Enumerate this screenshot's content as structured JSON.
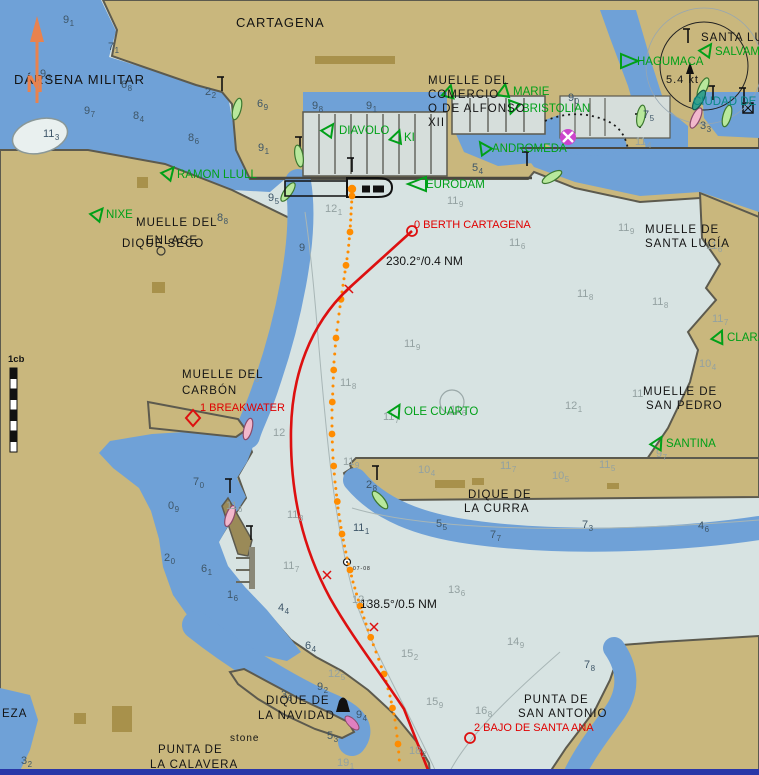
{
  "chart": {
    "north_label": "N",
    "scale_label": "1cb",
    "colors": {
      "water_deep": "#D7E3E2",
      "water_blue": "#6FA1D7",
      "lake": "#E9F0EF",
      "land": "#C9B77D",
      "land_dark": "#A8914B",
      "marina": "#D6DEDB",
      "edge": "#5C5A4E",
      "route_red": "#DD1010",
      "track_orange": "#FF8C00",
      "vessel_green": "#00A018",
      "vessel_teal": "#0A8A86",
      "sound_dark": "#3E5668",
      "sound_light": "#93A1A1",
      "north_orange": "#E8824E",
      "bottom_bar": "#2937A8"
    },
    "place_labels": [
      {
        "t": "CARTAGENA",
        "x": 236,
        "y": 27,
        "s": 13,
        "c": "#141414"
      },
      {
        "t": "DÁRSENA MILITAR",
        "x": 14,
        "y": 84,
        "s": 13,
        "c": "#141414"
      },
      {
        "t": "MUELLE DEL",
        "x": 428,
        "y": 84,
        "s": 11.5,
        "c": "#141414"
      },
      {
        "t": "COMERCIO",
        "x": 428,
        "y": 98,
        "s": 11.5,
        "c": "#141414"
      },
      {
        "t": "O DE ALFONSO",
        "x": 428,
        "y": 112,
        "s": 11.5,
        "c": "#141414"
      },
      {
        "t": "XII",
        "x": 428,
        "y": 126,
        "s": 11.5,
        "c": "#141414"
      },
      {
        "t": "SANTA LU",
        "x": 701,
        "y": 41,
        "s": 11.5,
        "c": "#141414"
      },
      {
        "t": "MUELLE DEL",
        "x": 136,
        "y": 226,
        "s": 11.5,
        "c": "#141414"
      },
      {
        "t": "ENLACE",
        "x": 146,
        "y": 244,
        "s": 11.5,
        "c": "#141414"
      },
      {
        "t": "DIQUE SECO",
        "x": 122,
        "y": 247,
        "s": 11.5,
        "c": "#141414"
      },
      {
        "t": "MUELLE DE",
        "x": 645,
        "y": 233,
        "s": 11.5,
        "c": "#141414"
      },
      {
        "t": "SANTA LUCÍA",
        "x": 645,
        "y": 247,
        "s": 11.5,
        "c": "#141414"
      },
      {
        "t": "MUELLE DEL",
        "x": 182,
        "y": 378,
        "s": 11.5,
        "c": "#141414"
      },
      {
        "t": "CARBÓN",
        "x": 182,
        "y": 394,
        "s": 11.5,
        "c": "#141414"
      },
      {
        "t": "MUELLE DE",
        "x": 643,
        "y": 395,
        "s": 11.5,
        "c": "#141414"
      },
      {
        "t": "SAN PEDRO",
        "x": 646,
        "y": 409,
        "s": 11.5,
        "c": "#141414"
      },
      {
        "t": "DIQUE DE",
        "x": 468,
        "y": 498,
        "s": 11.5,
        "c": "#141414"
      },
      {
        "t": "LA CURRA",
        "x": 464,
        "y": 512,
        "s": 11.5,
        "c": "#141414"
      },
      {
        "t": "DIQUE DE",
        "x": 266,
        "y": 704,
        "s": 11.5,
        "c": "#141414"
      },
      {
        "t": "LA NAVIDAD",
        "x": 258,
        "y": 719,
        "s": 11.5,
        "c": "#141414"
      },
      {
        "t": "PUNTA DE",
        "x": 158,
        "y": 753,
        "s": 11.5,
        "c": "#141414"
      },
      {
        "t": "LA CALAVERA",
        "x": 150,
        "y": 768,
        "s": 11.5,
        "c": "#141414"
      },
      {
        "t": "PUNTA DE",
        "x": 524,
        "y": 703,
        "s": 11.5,
        "c": "#141414"
      },
      {
        "t": "SAN ANTONIO",
        "x": 518,
        "y": 717,
        "s": 11.5,
        "c": "#141414"
      },
      {
        "t": "stone",
        "x": 230,
        "y": 741,
        "s": 10,
        "c": "#141414"
      },
      {
        "t": "EZA",
        "x": 2,
        "y": 717,
        "s": 11.5,
        "c": "#141414"
      },
      {
        "t": "5.4 kt",
        "x": 666,
        "y": 83,
        "s": 11,
        "c": "#141414"
      },
      {
        "t": "07-08",
        "x": 353,
        "y": 570,
        "s": 5,
        "c": "#141414"
      }
    ],
    "vessel_labels": [
      {
        "name": "HAGUMACA",
        "x": 637,
        "y": 65,
        "c": "#00A018",
        "tri": [
          629,
          61,
          90
        ],
        "shape": "right"
      },
      {
        "name": "SALVAMA",
        "x": 715,
        "y": 55,
        "c": "#00A018",
        "tri": [
          707,
          50,
          35
        ]
      },
      {
        "name": "MARIE",
        "x": 513,
        "y": 95,
        "c": "#00A018",
        "tri": [
          504,
          91,
          10
        ]
      },
      {
        "name": "BRISTOLIAN",
        "x": 522,
        "y": 112,
        "c": "#00A018",
        "tri": [
          513,
          107,
          200
        ]
      },
      {
        "name": "DIAVOLO",
        "x": 339,
        "y": 134,
        "c": "#00A018",
        "tri": [
          329,
          130,
          35
        ]
      },
      {
        "name": "KI",
        "x": 404,
        "y": 141,
        "c": "#00A018",
        "tri": [
          397,
          137,
          20
        ]
      },
      {
        "name": "ANDROMEDA",
        "x": 492,
        "y": 152,
        "c": "#00A018",
        "tri": [
          484,
          148,
          325
        ]
      },
      {
        "name": "EURODAM",
        "x": 426,
        "y": 188,
        "c": "#00A018",
        "tri": [
          417,
          184,
          0
        ],
        "shape": "left"
      },
      {
        "name": "RAMON LLULL",
        "x": 177,
        "y": 178,
        "c": "#00A018",
        "tri": [
          169,
          173,
          40
        ]
      },
      {
        "name": "NIXE",
        "x": 106,
        "y": 218,
        "c": "#00A018",
        "tri": [
          98,
          214,
          40
        ]
      },
      {
        "name": "OLE CUARTO",
        "x": 404,
        "y": 415,
        "c": "#00A018",
        "tri": [
          396,
          411,
          30
        ]
      },
      {
        "name": "CLARA",
        "x": 727,
        "y": 341,
        "c": "#00A018",
        "tri": [
          719,
          337,
          25
        ]
      },
      {
        "name": "SANTINA",
        "x": 666,
        "y": 447,
        "c": "#00A018",
        "tri": [
          658,
          443,
          30
        ]
      },
      {
        "name": "CIUDAD DE",
        "x": 693,
        "y": 105,
        "c": "#0A8A86",
        "tri": null
      },
      {
        "name": "",
        "x": 0,
        "y": 0,
        "c": "#00A018",
        "tri": [
          449,
          92,
          15
        ]
      }
    ],
    "route": {
      "path": "M412,231 L348,289 C310,325 292,375 291,430 C290,495 303,548 330,598 C352,637 381,674 404,709 L430,775",
      "tick_marks": [
        [
          349,
          289
        ],
        [
          327,
          575
        ],
        [
          374,
          627
        ]
      ],
      "waypoints": [
        {
          "name": "0 BERTH CARTAGENA",
          "x": 412,
          "y": 231,
          "symbol": "circle",
          "lx": 414,
          "ly": 228
        },
        {
          "name": "1 BREAKWATER",
          "x": 193,
          "y": 418,
          "symbol": "diamond",
          "lx": 200,
          "ly": 411
        },
        {
          "name": "2 BAJO DE SANTA ANA",
          "x": 470,
          "y": 738,
          "symbol": "circle",
          "lx": 474,
          "ly": 731
        }
      ],
      "legs": [
        {
          "label": "230.2°/0.4 NM",
          "x": 386,
          "y": 265
        },
        {
          "label": "138.5°/0.5 NM",
          "x": 360,
          "y": 608
        }
      ]
    },
    "track": {
      "points": [
        [
          352,
          196
        ],
        [
          351,
          214
        ],
        [
          350,
          232
        ],
        [
          348,
          252
        ],
        [
          345,
          272
        ],
        [
          342,
          292
        ],
        [
          339,
          314
        ],
        [
          336,
          338
        ],
        [
          334,
          362
        ],
        [
          333,
          386
        ],
        [
          332,
          410
        ],
        [
          332,
          434
        ],
        [
          333,
          458
        ],
        [
          335,
          482
        ],
        [
          338,
          508
        ],
        [
          342,
          534
        ],
        [
          347,
          558
        ],
        [
          353,
          582
        ],
        [
          360,
          606
        ],
        [
          368,
          630
        ],
        [
          376,
          652
        ],
        [
          384,
          674
        ],
        [
          390,
          696
        ],
        [
          395,
          720
        ],
        [
          398,
          744
        ],
        [
          400,
          768
        ]
      ],
      "ownship": [
        352,
        189
      ]
    },
    "soundings": [
      [
        63,
        14,
        "9",
        "1",
        "d"
      ],
      [
        108,
        41,
        "7",
        "1",
        "d"
      ],
      [
        40,
        68,
        "9",
        "3",
        "d"
      ],
      [
        121,
        79,
        "6",
        "8",
        "d"
      ],
      [
        84,
        105,
        "9",
        "7",
        "d"
      ],
      [
        133,
        110,
        "8",
        "4",
        "d"
      ],
      [
        43,
        128,
        "11",
        "3",
        "d"
      ],
      [
        205,
        86,
        "2",
        "2",
        "d"
      ],
      [
        188,
        132,
        "8",
        "6",
        "d"
      ],
      [
        257,
        98,
        "6",
        "9",
        "d"
      ],
      [
        312,
        100,
        "9",
        "8",
        "d"
      ],
      [
        366,
        100,
        "9",
        "1",
        "d"
      ],
      [
        258,
        142,
        "9",
        "1",
        "d"
      ],
      [
        268,
        192,
        "9",
        "5",
        "d"
      ],
      [
        217,
        212,
        "8",
        "8",
        "d"
      ],
      [
        299,
        242,
        "9",
        "",
        "d"
      ],
      [
        568,
        92,
        "9",
        "0",
        "d"
      ],
      [
        643,
        109,
        "7",
        "5",
        "d"
      ],
      [
        700,
        120,
        "3",
        "3",
        "d"
      ],
      [
        635,
        136,
        "11",
        "4",
        "l"
      ],
      [
        472,
        162,
        "5",
        "4",
        "d"
      ],
      [
        494,
        141,
        "10",
        "8",
        "l"
      ],
      [
        447,
        195,
        "11",
        "9",
        "l"
      ],
      [
        325,
        203,
        "12",
        "1",
        "l"
      ],
      [
        509,
        237,
        "11",
        "6",
        "l"
      ],
      [
        618,
        222,
        "11",
        "9",
        "l"
      ],
      [
        706,
        240,
        "11",
        "6",
        "l"
      ],
      [
        577,
        288,
        "11",
        "8",
        "l"
      ],
      [
        652,
        296,
        "11",
        "8",
        "l"
      ],
      [
        712,
        313,
        "11",
        "7",
        "l"
      ],
      [
        404,
        338,
        "11",
        "9",
        "l"
      ],
      [
        340,
        377,
        "11",
        "8",
        "l"
      ],
      [
        343,
        456,
        "11",
        "9",
        "l"
      ],
      [
        273,
        427,
        "12",
        "",
        "l"
      ],
      [
        248,
        370,
        "7",
        "6",
        "l"
      ],
      [
        383,
        411,
        "11",
        "7",
        "l"
      ],
      [
        450,
        404,
        "11",
        "6",
        "l",
        "c"
      ],
      [
        565,
        400,
        "12",
        "1",
        "l"
      ],
      [
        500,
        460,
        "11",
        "7",
        "l"
      ],
      [
        599,
        459,
        "11",
        "5",
        "l"
      ],
      [
        418,
        464,
        "10",
        "4",
        "l"
      ],
      [
        552,
        470,
        "10",
        "5",
        "l"
      ],
      [
        632,
        388,
        "11",
        "",
        "l"
      ],
      [
        699,
        358,
        "10",
        "4",
        "l"
      ],
      [
        656,
        448,
        "9",
        "7",
        "l"
      ],
      [
        366,
        479,
        "2",
        "8",
        "d"
      ],
      [
        353,
        522,
        "11",
        "1",
        "d"
      ],
      [
        436,
        518,
        "5",
        "5",
        "d"
      ],
      [
        490,
        529,
        "7",
        "7",
        "d"
      ],
      [
        582,
        519,
        "7",
        "3",
        "d"
      ],
      [
        698,
        520,
        "4",
        "6",
        "d"
      ],
      [
        287,
        509,
        "11",
        "8",
        "l"
      ],
      [
        283,
        560,
        "11",
        "7",
        "l"
      ],
      [
        226,
        500,
        "11",
        "6",
        "l"
      ],
      [
        193,
        476,
        "7",
        "0",
        "d"
      ],
      [
        168,
        500,
        "0",
        "9",
        "d"
      ],
      [
        164,
        552,
        "2",
        "0",
        "d"
      ],
      [
        201,
        563,
        "6",
        "1",
        "d"
      ],
      [
        227,
        589,
        "1",
        "6",
        "d"
      ],
      [
        278,
        602,
        "4",
        "4",
        "d"
      ],
      [
        305,
        640,
        "6",
        "4",
        "d"
      ],
      [
        448,
        584,
        "13",
        "6",
        "l"
      ],
      [
        352,
        594,
        "12",
        "7",
        "l"
      ],
      [
        401,
        648,
        "15",
        "2",
        "l"
      ],
      [
        507,
        636,
        "14",
        "9",
        "l"
      ],
      [
        328,
        668,
        "12",
        "5",
        "l"
      ],
      [
        317,
        681,
        "9",
        "2",
        "d"
      ],
      [
        281,
        689,
        "3",
        "6",
        "d"
      ],
      [
        356,
        709,
        "9",
        "4",
        "d"
      ],
      [
        327,
        730,
        "5",
        "3",
        "d"
      ],
      [
        337,
        757,
        "19",
        "1",
        "l"
      ],
      [
        426,
        696,
        "15",
        "9",
        "l"
      ],
      [
        475,
        705,
        "16",
        "8",
        "l"
      ],
      [
        409,
        745,
        "18",
        "2",
        "l"
      ],
      [
        584,
        659,
        "7",
        "8",
        "d"
      ],
      [
        21,
        755,
        "3",
        "2",
        "d"
      ]
    ],
    "hulls": [
      {
        "x": 237,
        "y": 109,
        "r": 195,
        "c": "green"
      },
      {
        "x": 299,
        "y": 156,
        "r": 170,
        "c": "green"
      },
      {
        "x": 288,
        "y": 192,
        "r": 215,
        "c": "green"
      },
      {
        "x": 380,
        "y": 500,
        "r": 140,
        "c": "green"
      },
      {
        "x": 552,
        "y": 177,
        "r": 240,
        "c": "green"
      },
      {
        "x": 703,
        "y": 88,
        "r": 205,
        "c": "green"
      },
      {
        "x": 727,
        "y": 116,
        "r": 195,
        "c": "green"
      },
      {
        "x": 641,
        "y": 116,
        "r": 190,
        "c": "green"
      },
      {
        "x": 248,
        "y": 429,
        "r": 195,
        "c": "pink"
      },
      {
        "x": 230,
        "y": 516,
        "r": 200,
        "c": "pink"
      },
      {
        "x": 696,
        "y": 118,
        "r": 205,
        "c": "pink"
      },
      {
        "x": 699,
        "y": 100,
        "r": 210,
        "c": "teal"
      }
    ],
    "beacons": [
      [
        222,
        89
      ],
      [
        300,
        149
      ],
      [
        527,
        164
      ],
      [
        640,
        126
      ],
      [
        688,
        41
      ],
      [
        713,
        98
      ],
      [
        744,
        100
      ],
      [
        377,
        478
      ],
      [
        230,
        491
      ],
      [
        251,
        538
      ],
      [
        352,
        170
      ]
    ]
  }
}
